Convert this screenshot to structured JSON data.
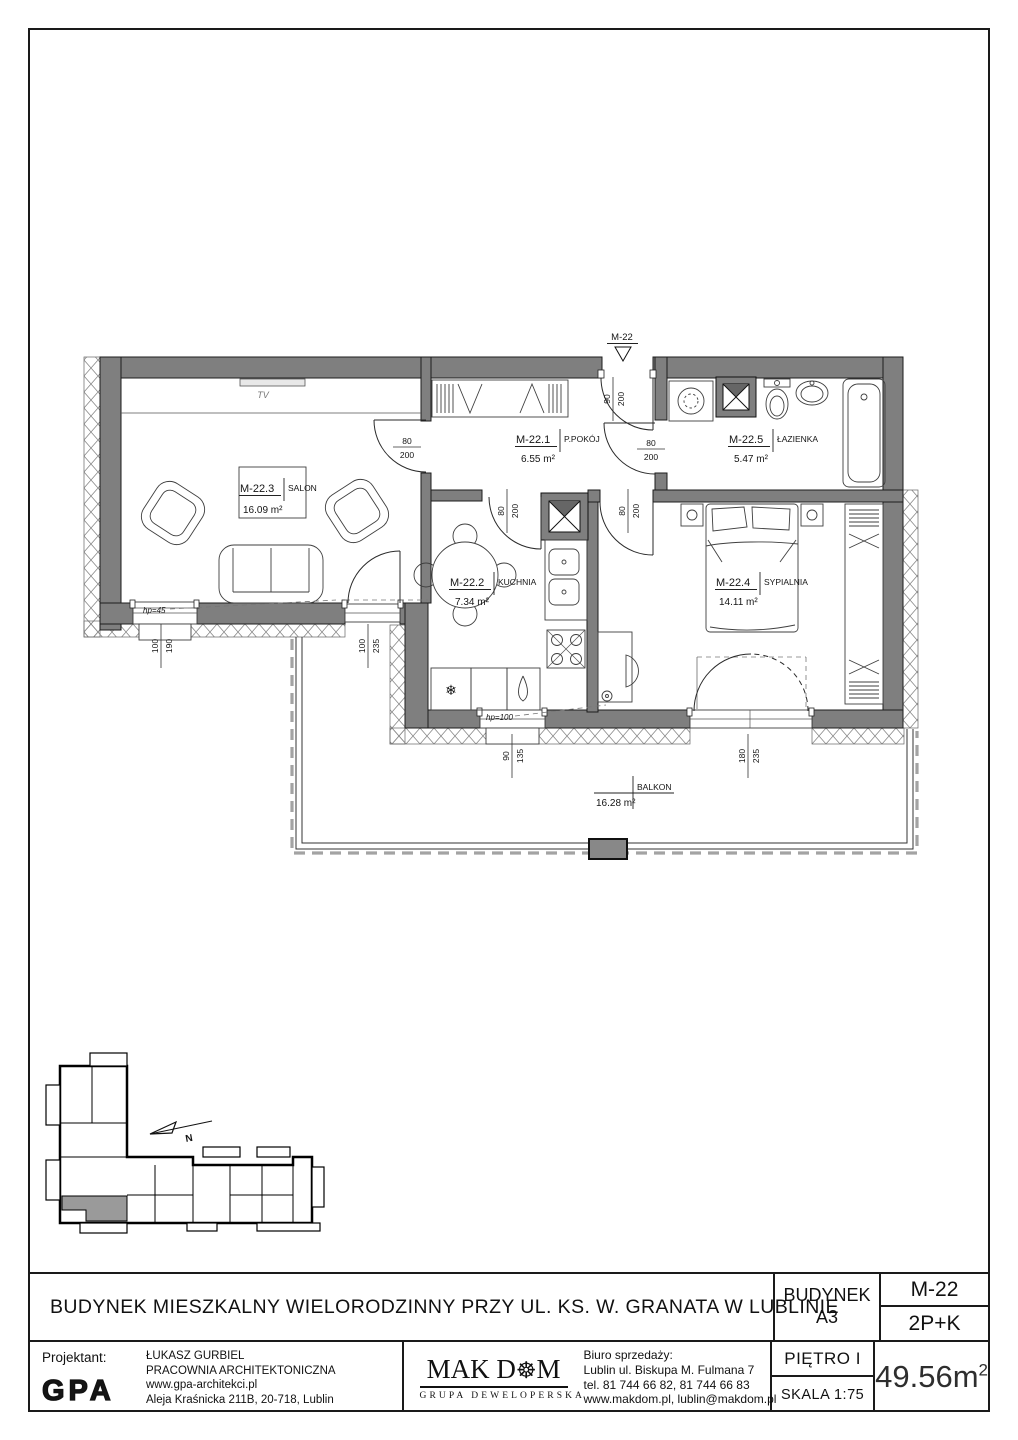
{
  "plan": {
    "marker": "M-22",
    "tv": "TV",
    "north": "N",
    "rooms": {
      "ppokoj": {
        "id": "M-22.1",
        "name": "P.POKÓJ",
        "area": "6.55 m²"
      },
      "kuchnia": {
        "id": "M-22.2",
        "name": "KUCHNIA",
        "area": "7.34 m²"
      },
      "salon": {
        "id": "M-22.3",
        "name": "SALON",
        "area": "16.09 m²"
      },
      "sypialnia": {
        "id": "M-22.4",
        "name": "SYPIALNIA",
        "area": "14.11 m²"
      },
      "lazienka": {
        "id": "M-22.5",
        "name": "ŁAZIENKA",
        "area": "5.47 m²"
      },
      "balkon": {
        "name": "BALKON",
        "area": "16.28 m²"
      }
    },
    "dims": {
      "entrance": {
        "top": "90",
        "bottom": "200"
      },
      "salon_door": {
        "top": "80",
        "bottom": "200"
      },
      "bath_door": {
        "top": "80",
        "bottom": "200"
      },
      "kitchen_door": {
        "top": "80",
        "bottom": "200"
      },
      "bedroom_door": {
        "top": "80",
        "bottom": "200"
      },
      "salon_window": {
        "top": "100",
        "bottom": "190"
      },
      "salon_balcony_door": {
        "top": "100",
        "bottom": "235"
      },
      "kitchen_window": {
        "top": "90",
        "bottom": "135"
      },
      "bedroom_balcony_door": {
        "top": "180",
        "bottom": "235"
      }
    },
    "notes": {
      "salon_window": "hp=45",
      "kitchen_window": "hp=100"
    }
  },
  "title_block": {
    "main_title": "BUDYNEK MIESZKALNY WIELORODZINNY PRZY UL. KS. W. GRANATA W LUBLINIE",
    "building_label": "BUDYNEK",
    "building_value": "A3",
    "unit": "M-22",
    "layout": "2P+K",
    "floor": "PIĘTRO I",
    "scale": "SKALA 1:75",
    "area": {
      "value": "49.56m",
      "sup": "2"
    },
    "designer": {
      "label": "Projektant:",
      "logo": "GPA",
      "name": "ŁUKASZ  GURBIEL",
      "studio": "PRACOWNIA ARCHITEKTONICZNA",
      "web": "www.gpa-architekci.pl",
      "address": "Aleja Kraśnicka 211B, 20-718, Lublin"
    },
    "developer": {
      "name_pre": "MAK D",
      "name_post": "M",
      "tagline": "GRUPA DEWELOPERSKA"
    },
    "sales": {
      "label": "Biuro sprzedaży:",
      "line1": "Lublin ul. Biskupa M. Fulmana 7",
      "line2": "tel. 81 744 66 82, 81 744 66 83",
      "line3": "www.makdom.pl, lublin@makdom.pl"
    }
  }
}
